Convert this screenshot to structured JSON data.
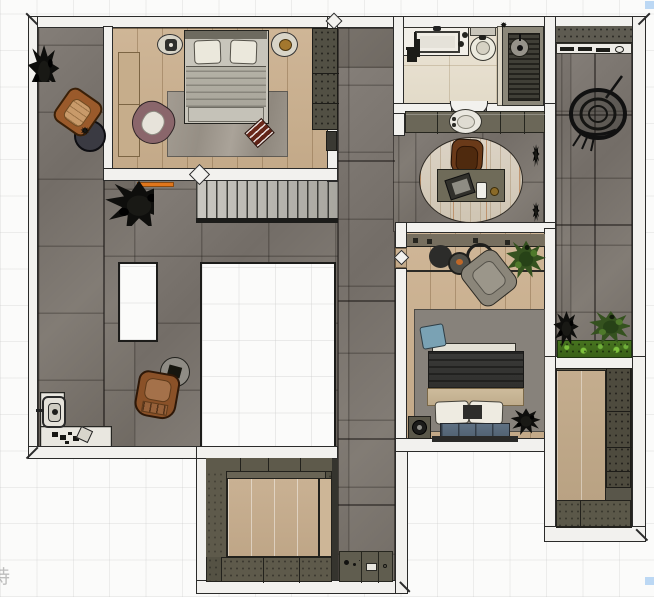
{
  "meta": {
    "type": "floor-plan",
    "view": "top-down-render"
  },
  "watermark": {
    "text": "持"
  },
  "markers": {
    "corner_square_color": "#bcd8f4"
  },
  "palette": {
    "wall": "#f2f1ee",
    "wall_outline": "#2b2b2a",
    "stone_tile": "#7b756f",
    "wood_floor": "#cbb293",
    "bathroom_tile": "#e9e2d3",
    "cabinet_olive": "#6b6758",
    "wardrobe_dark": "#525044",
    "rug_gray": "#9b948a",
    "rug_dark": "#87827b",
    "oval_rug": "#d7cdbe",
    "accent_orange": "#e0761c",
    "leather_brown": "#9a5a2b",
    "chair_mauve": "#8a666b",
    "cushion_red": "#6e2a1c",
    "pillow_blue": "#7aa2b4",
    "denim_bench": "#5f7183",
    "duvet_dark": "#3a3a38",
    "blanket_beige": "#c5b293",
    "hedge_green": "#47741f",
    "plant_dark": "#0e0e0c",
    "shower_slats": "#403f37"
  },
  "rooms": [
    {
      "id": "bedroom-1",
      "label": "Bedroom 1",
      "floor": "wood",
      "furniture": [
        "double-bed",
        "pillow-left",
        "pillow-right",
        "nightstand-left",
        "nightstand-right",
        "area-rug",
        "accent-armchair",
        "floor-cushion",
        "wardrobe",
        "low-bench"
      ]
    },
    {
      "id": "terrace",
      "label": "Terrace",
      "floor": "stone-tile",
      "furniture": [
        "lounge-chair-north",
        "round-table-north",
        "corner-plant",
        "center-plant",
        "skylight-small",
        "skylight-large",
        "lounge-chair-south",
        "round-table-south",
        "outdoor-faucet",
        "marble-deck",
        "decor-scatter",
        "orange-doormat"
      ]
    },
    {
      "id": "stairs",
      "label": "Staircase",
      "floor": "treads"
    },
    {
      "id": "hallway",
      "label": "Hallway",
      "floor": "stone-tile",
      "furniture": [
        "console-cabinet"
      ]
    },
    {
      "id": "bathroom",
      "label": "Bathroom",
      "floor": "marble-tile",
      "furniture": [
        "vanity-counter",
        "basin",
        "toilet",
        "partition",
        "walk-in-shower",
        "shower-head",
        "plant"
      ]
    },
    {
      "id": "study",
      "label": "Study",
      "floor": "stone-tile",
      "furniture": [
        "storage-console",
        "vessel-basin",
        "oval-rug",
        "desk",
        "laptop",
        "phone",
        "desk-chair",
        "wall-plants"
      ]
    },
    {
      "id": "bedroom-2",
      "label": "Bedroom 2",
      "floor": "wood",
      "furniture": [
        "media-shelf",
        "round-table",
        "tray-table",
        "ring-table",
        "lounge-chair",
        "potted-plant",
        "area-rug",
        "blue-pillow",
        "double-bed",
        "cushion-bench",
        "nightstand",
        "floor-plant"
      ]
    },
    {
      "id": "balcony",
      "label": "Balcony",
      "floor": "stone-tile",
      "furniture": [
        "bar-shelf",
        "hanging-egg-chair",
        "potted-plant",
        "green-planter",
        "hedge-planter"
      ]
    },
    {
      "id": "walk-in-closet-1",
      "label": "Walk-in Closet 1",
      "floor": "wood-platform",
      "furniture": [
        "wardrobe-top",
        "wardrobe-left",
        "wardrobe-bottom",
        "floor-platform"
      ]
    },
    {
      "id": "walk-in-closet-2",
      "label": "Walk-in Closet 2",
      "floor": "wood",
      "furniture": [
        "wardrobe-column",
        "storage-cabinets"
      ]
    }
  ]
}
